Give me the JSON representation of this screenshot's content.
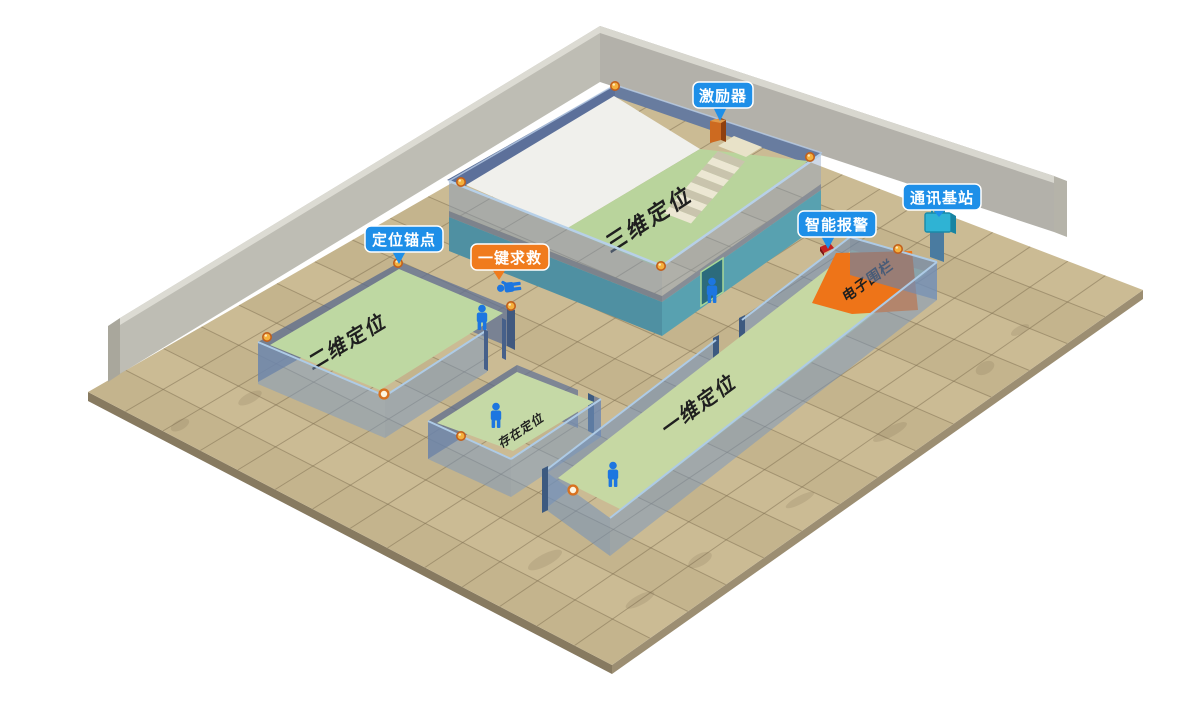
{
  "scene": {
    "description_type": "indoor-positioning-isometric-diagram"
  },
  "badges": {
    "exciter": {
      "label": "激励器",
      "color": "#1e8fe8"
    },
    "comm_station": {
      "label": "通讯基站",
      "color": "#1e8fe8"
    },
    "smart_alarm": {
      "label": "智能报警",
      "color": "#1e8fe8"
    },
    "anchor_point": {
      "label": "定位锚点",
      "color": "#1e8fe8"
    },
    "sos": {
      "label": "一键求救",
      "color": "#f07b1d"
    }
  },
  "zones": {
    "zone_3d": "三维定位",
    "zone_2d": "二维定位",
    "zone_presence": "存在定位",
    "zone_1d": "一维定位",
    "fence": "电子围栏"
  },
  "colors": {
    "badge_blue": "#1e8fe8",
    "badge_orange": "#f07b1d",
    "fence_orange": "#ee7418",
    "floor_green": "#c0d7a0",
    "ground_tan": "#cbbb94",
    "wall_teal": "#4f90a2",
    "wall_glass_blue": "#7ea0c8",
    "person_blue": "#1d76e0",
    "anchor_orange": "#f5b13d",
    "station_cyan": "#2fb3d4",
    "alarm_red": "#c32222",
    "exciter_orange": "#cd6a20"
  }
}
